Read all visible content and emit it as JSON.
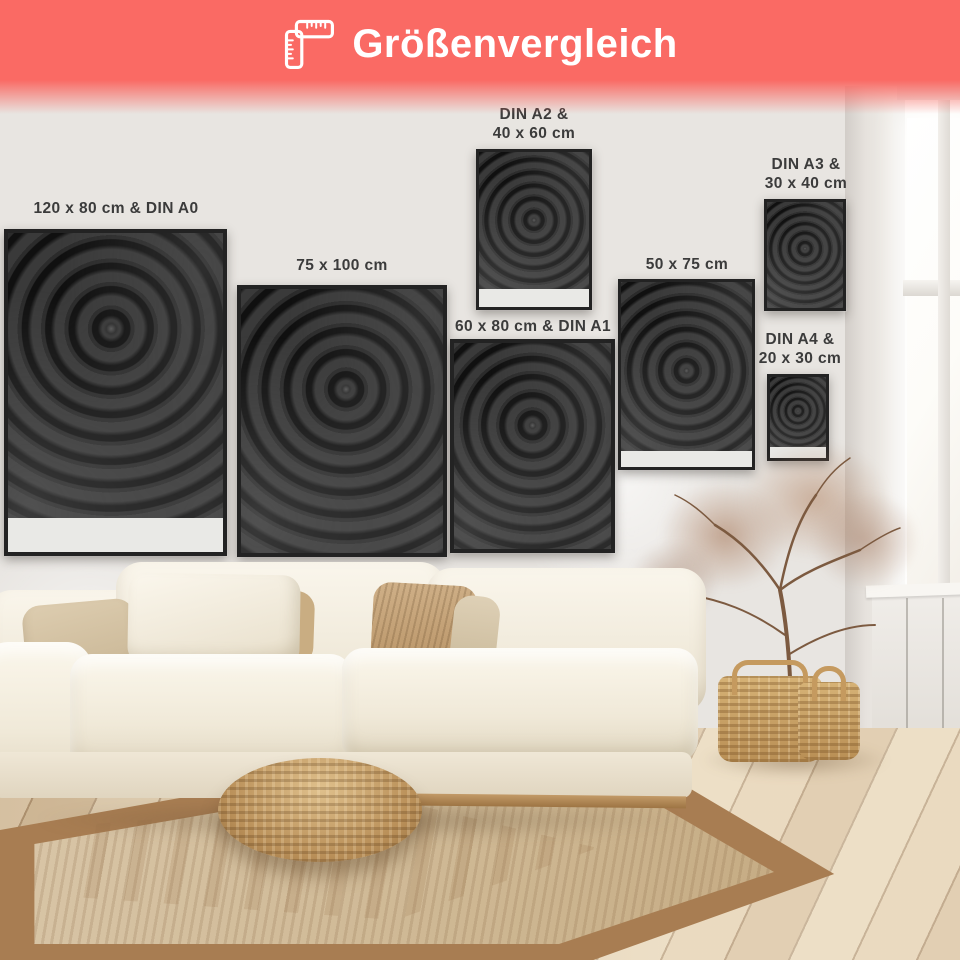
{
  "header": {
    "title": "Größenvergleich",
    "icon": "folding-ruler-icon",
    "banner_color": "#fa6a64",
    "title_color": "#ffffff"
  },
  "posters": [
    {
      "name": "poster-120x80-din-a0",
      "label": "120 x 80 cm & DIN A0"
    },
    {
      "name": "poster-75x100",
      "label": "75 x 100 cm"
    },
    {
      "name": "poster-din-a2-40x60",
      "label": "DIN A2 &\n40 x 60 cm"
    },
    {
      "name": "poster-60x80-din-a1",
      "label": "60 x 80 cm & DIN A1"
    },
    {
      "name": "poster-50x75",
      "label": "50 x 75 cm"
    },
    {
      "name": "poster-din-a3-30x40",
      "label": "DIN A3 &\n30 x 40 cm"
    },
    {
      "name": "poster-din-a4-20x30",
      "label": "DIN A4 &\n20 x 30 cm"
    }
  ],
  "scene": {
    "poster_artwork": "black-rose-photo",
    "label_color": "#3b3b3b"
  }
}
